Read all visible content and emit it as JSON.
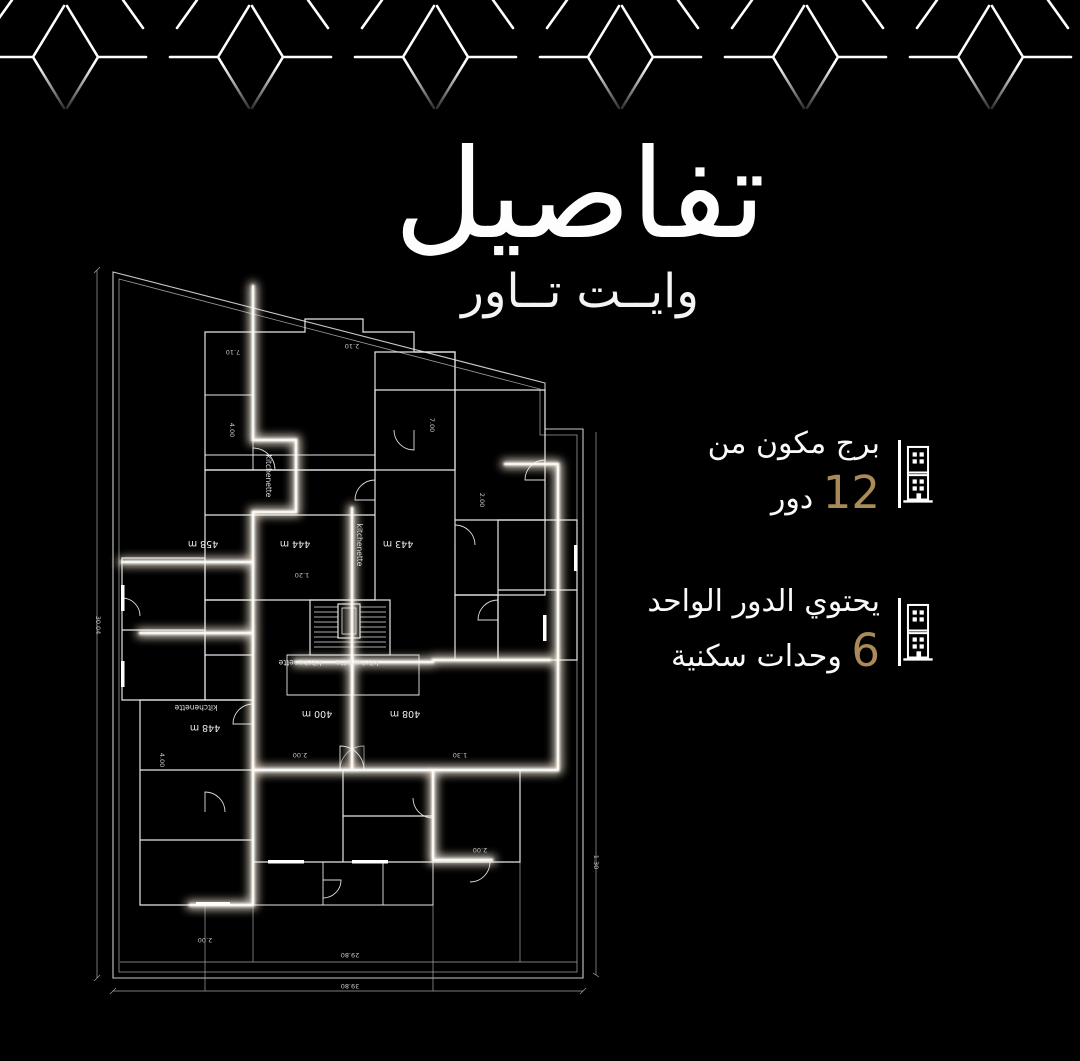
{
  "background": "#000000",
  "accent_gold": "#a98a58",
  "header": {
    "title": "تفاصيل",
    "subtitle": "وايــت تــاور"
  },
  "decor": {
    "pattern_icon": "hex-branch-border",
    "color": "#ffffff"
  },
  "info_cards": [
    {
      "icon": "building-icon",
      "line1": "برج مكون من",
      "value": "12",
      "unit": "دور"
    },
    {
      "icon": "building-icon",
      "line1": "يحتوي الدور الواحد",
      "value": "6",
      "unit": "وحدات سكنية"
    }
  ],
  "plan": {
    "room_labels": [
      "458 m",
      "444 m",
      "443 m",
      "448 m",
      "400 m",
      "408 m"
    ],
    "kitchen_labels": [
      "kitchenette",
      "kitchenette",
      "kitchenette",
      "kitchenette",
      "kitchenette"
    ],
    "dims": [
      "7.10",
      "2.10",
      "4.00",
      "1.20",
      "2.00",
      "2.00",
      "1.30",
      "4.00",
      "2.00",
      "30.04",
      "1.30",
      "29.80",
      "39.80",
      "2.00",
      "7.00"
    ]
  }
}
